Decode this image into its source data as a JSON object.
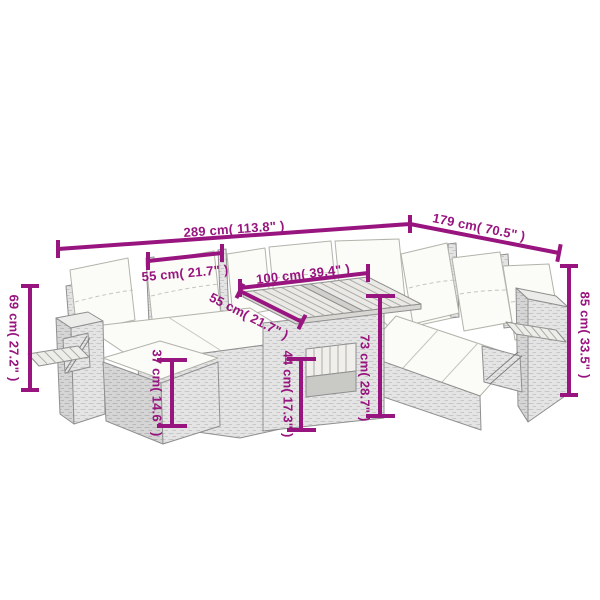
{
  "diagram": {
    "type": "product-dimension-diagram",
    "subject": "rattan garden corner sofa set with ottoman and wooden-top table",
    "background": "#FFFFFF"
  },
  "colors": {
    "dimension_accent": "#98157F",
    "furniture_outline": "#8F8F8F",
    "rattan_light": "#E4E4E4",
    "rattan_dark": "#D5D5D5",
    "cushion": "#FBFBF7",
    "wood": "#EAE9E5"
  },
  "dimensions": {
    "overall_width": "289 cm( 113.8\" )",
    "wing_width": "179 cm( 70.5\" )",
    "seat_width": "55 cm( 21.7\" )",
    "table_length": "100 cm( 39.4\" )",
    "table_depth": "55 cm( 21.7\" )",
    "left_height": "69 cm( 27.2\" )",
    "back_height": "85 cm( 33.5\" )",
    "table_height": "73 cm( 28.7\" )",
    "table_base_height": "44 cm( 17.3\" )",
    "ottoman_height": "37 cm( 14.6\" )"
  }
}
